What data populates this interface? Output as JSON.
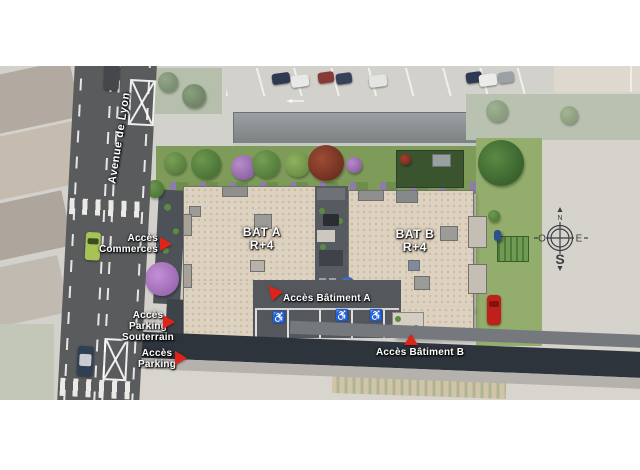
{
  "plan": {
    "street_label": "Avenue de Lyon",
    "buildings": [
      {
        "name": "BAT A",
        "floors": "R+4"
      },
      {
        "name": "BAT B",
        "floors": "R+4"
      }
    ],
    "access": {
      "commerces": {
        "line1": "Accès",
        "line2": "Commerces"
      },
      "parking_souterrain": {
        "line1": "Accès",
        "line2": "Parking",
        "line3": "Souterrain"
      },
      "parking": {
        "line1": "Accès",
        "line2": "Parking"
      },
      "batiment_a": "Accès Bâtiment A",
      "batiment_b": "Accès Bâtiment B"
    },
    "compass": {
      "north": "N",
      "west": "O",
      "east": "E",
      "south": "S"
    },
    "symbols": {
      "handicap": "♿"
    },
    "colors": {
      "marker_red": "#e02318",
      "building_beige": "#ddd1bf",
      "label_white": "#ffffff",
      "lawn_green": "#93ad6c",
      "road_dark": "#2e343c"
    }
  }
}
